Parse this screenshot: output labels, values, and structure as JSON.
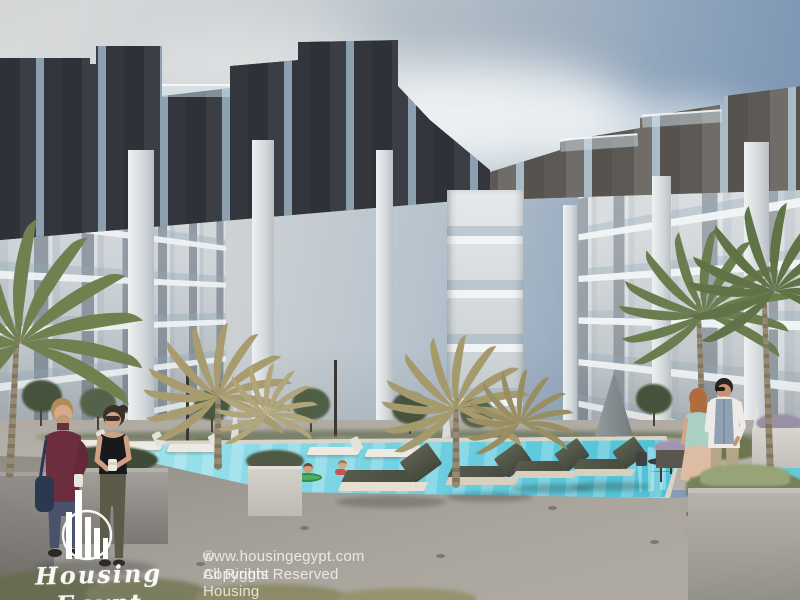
{
  "watermark": {
    "brand_script": "Housing Egypt",
    "logo_icon": "housing-egypt-circle-bars-logo"
  },
  "copyright": {
    "line1": "© Copyright Housing Egypt.",
    "line2": "www.housingegypt.com All Rights Reserved"
  },
  "scene": {
    "description": "3D architectural rendering of a U-shaped modern apartment complex courtyard with swimming pool, sun loungers, palm trees and residents",
    "elements": [
      "apartment-building",
      "swimming-pool",
      "sun-loungers",
      "palm-trees",
      "couple-foreground-left",
      "couple-walking-right",
      "children-in-pool",
      "planters",
      "umbrellas",
      "landscaping"
    ],
    "colors": {
      "sky_left": "#d8dadb",
      "sky_right": "#7490ad",
      "facade_light": "#cfd4d8",
      "facade_dark_band": "#34383e",
      "facade_brown_band": "#676360",
      "pool_water": "#62cbdd",
      "pool_coping": "#d9d4c7",
      "deck": "#a19d96",
      "palm_green": "#6d7f52",
      "palm_dry": "#a89c6f",
      "lounger_mesh": "#4d5245",
      "lounger_frame": "#d8cfbc",
      "watermark_white": "#ffffff"
    }
  }
}
